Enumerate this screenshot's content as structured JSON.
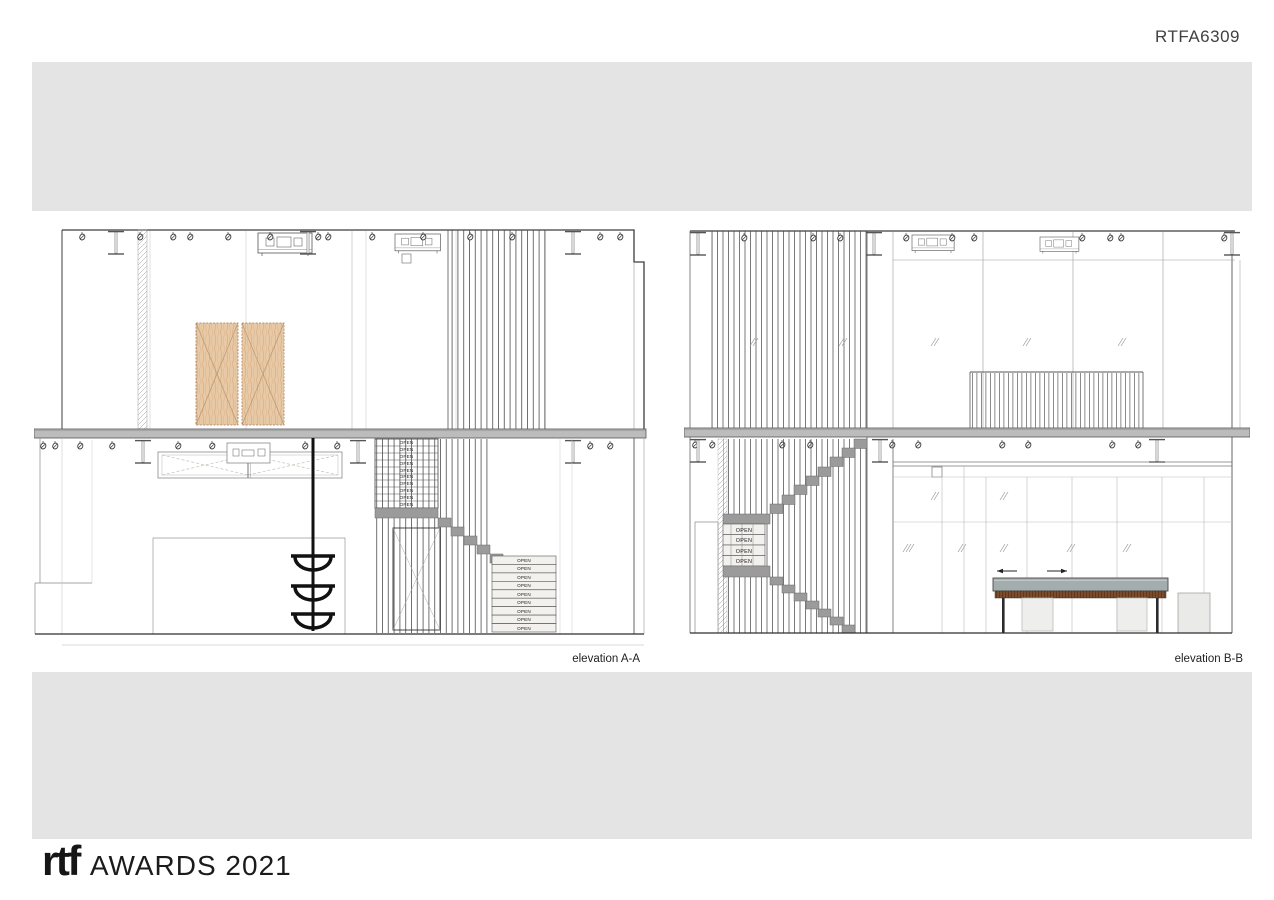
{
  "header": {
    "code": "RTFA6309"
  },
  "drawings": {
    "left_label": "elevation A-A",
    "right_label": "elevation B-B",
    "open_label": "OPEN",
    "colors": {
      "band_gray": "#e4e4e4",
      "slab_gray": "#bcbcbc",
      "step_gray": "#9b9b9b",
      "door_wood": "#e8c9a6",
      "counter_top": "#a3adad",
      "counter_wood": "#7a4c2c",
      "cabinet": "#eeeeec",
      "line": "#3d3d3d"
    }
  },
  "footer": {
    "logo_text": "rtf",
    "awards_text": "AWARDS 2021"
  }
}
